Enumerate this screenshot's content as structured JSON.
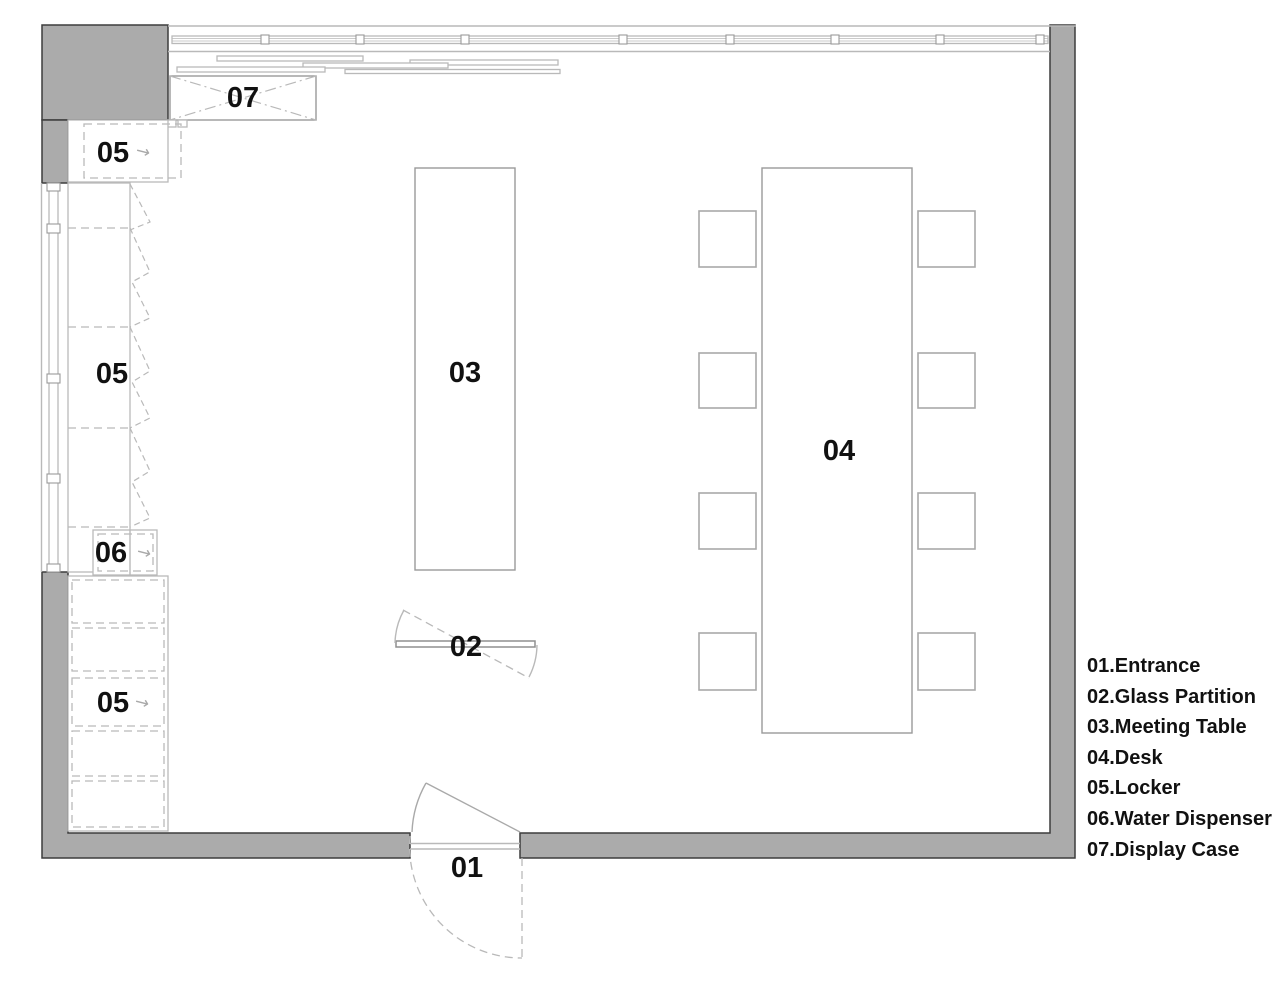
{
  "plan": {
    "furniture_labels": {
      "entrance": "01",
      "glass_partition": "02",
      "meeting_table": "03",
      "desk": "04",
      "locker": "05",
      "water_dispenser": "06",
      "display_case": "07"
    },
    "open_direction_arrow": "→"
  },
  "legend": {
    "items": [
      {
        "text": "01.Entrance"
      },
      {
        "text": "02.Glass Partition"
      },
      {
        "text": "03.Meeting Table"
      },
      {
        "text": "04.Desk"
      },
      {
        "text": "05.Locker"
      },
      {
        "text": "06.Water Dispenser"
      },
      {
        "text": "07.Display Case"
      }
    ]
  },
  "colors": {
    "wall_fill": "#ababab",
    "wall_edge": "#3d3d3d",
    "line_mid": "#9a9a9a",
    "line_lite": "#b9b9b9",
    "ink": "#111111",
    "bg": "#ffffff"
  }
}
